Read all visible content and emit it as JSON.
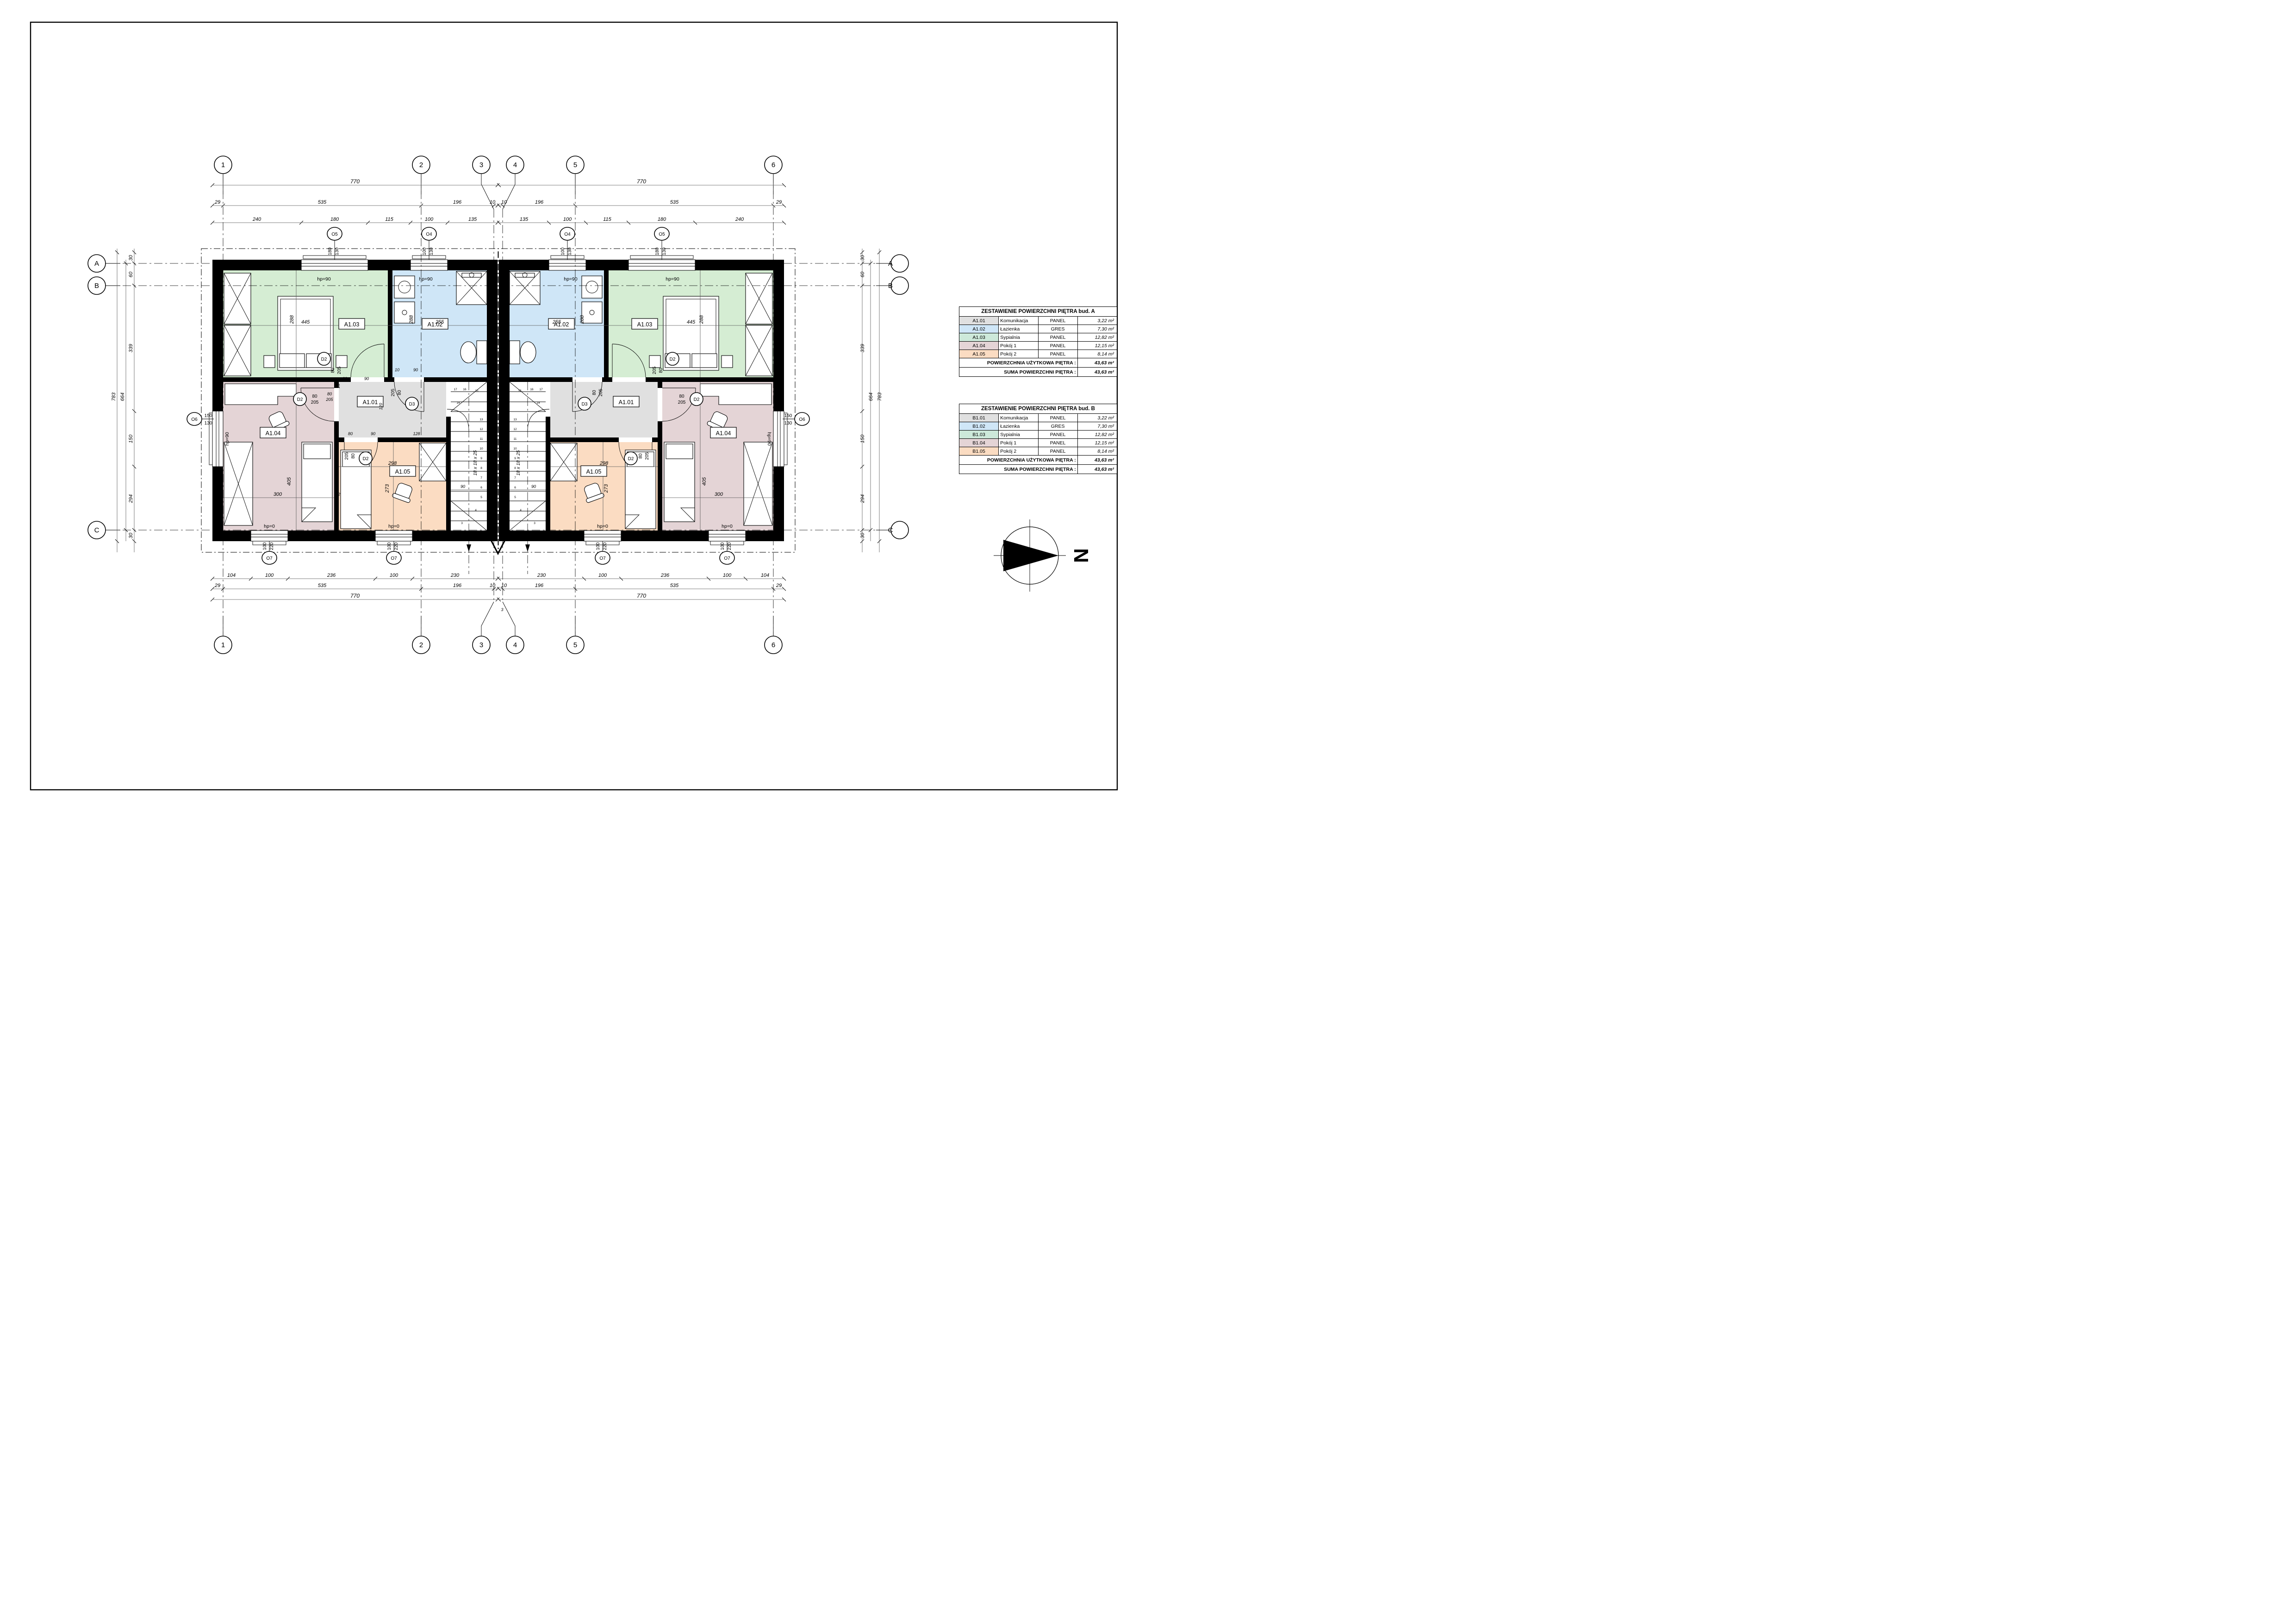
{
  "tables": {
    "a": {
      "title": "ZESTAWIENIE POWIERZCHNI PIĘTRA bud. A",
      "rows": [
        {
          "code": "A1.01",
          "name": "Komunikacja",
          "finish": "PANEL",
          "area": "3,22 m²",
          "color": "#e0e0e0"
        },
        {
          "code": "A1.02",
          "name": "Łazienka",
          "finish": "GRES",
          "area": "7,30 m²",
          "color": "#cfe6f7"
        },
        {
          "code": "A1.03",
          "name": "Sypialnia",
          "finish": "PANEL",
          "area": "12,82 m²",
          "color": "#cde9da"
        },
        {
          "code": "A1.04",
          "name": "Pokój 1",
          "finish": "PANEL",
          "area": "12,15 m²",
          "color": "#e4d4d6"
        },
        {
          "code": "A1.05",
          "name": "Pokój 2",
          "finish": "PANEL",
          "area": "8,14 m²",
          "color": "#fbdcc2"
        }
      ],
      "total_label": "POWIERZCHNIA UŻYTKOWA  PIĘTRA   :",
      "total_value": "43,63 m²",
      "sum_label": "SUMA POWIERZCHNI  PIĘTRA   :",
      "sum_value": "43,63 m²"
    },
    "b": {
      "title": "ZESTAWIENIE POWIERZCHNI PIĘTRA bud. B",
      "rows": [
        {
          "code": "B1.01",
          "name": "Komunikacja",
          "finish": "PANEL",
          "area": "3,22 m²",
          "color": "#e0e0e0"
        },
        {
          "code": "B1.02",
          "name": "Łazienka",
          "finish": "GRES",
          "area": "7,30 m²",
          "color": "#cfe6f7"
        },
        {
          "code": "B1.03",
          "name": "Sypialnia",
          "finish": "PANEL",
          "area": "12,82 m²",
          "color": "#cde9da"
        },
        {
          "code": "B1.04",
          "name": "Pokój 1",
          "finish": "PANEL",
          "area": "12,15 m²",
          "color": "#e4d4d6"
        },
        {
          "code": "B1.05",
          "name": "Pokój 2",
          "finish": "PANEL",
          "area": "8,14 m²",
          "color": "#fbdcc2"
        }
      ],
      "total_label": "POWIERZCHNIA UŻYTKOWA  PIĘTRA   :",
      "total_value": "43,63 m²",
      "sum_label": "SUMA POWIERZCHNI  PIĘTRA   :",
      "sum_value": "43,63 m²"
    }
  },
  "north": {
    "label": "N"
  },
  "colors": {
    "komunikacja": "#e0e0e0",
    "lazienka": "#cfe6f7",
    "sypialnia": "#d5edd3",
    "pokoj1": "#e4d4d6",
    "pokoj2": "#fbdcc2",
    "wall": "#000000"
  },
  "plan": {
    "axes": {
      "cols": [
        "1",
        "2",
        "3",
        "4",
        "5",
        "6"
      ],
      "rows": [
        "A",
        "B",
        "C"
      ]
    },
    "rooms": {
      "a101": "A1.01",
      "a102": "A1.02",
      "a103": "A1.03",
      "a104": "A1.04",
      "a105": "A1.05"
    },
    "hp90": "hp=90",
    "hp0": "hp=0",
    "markers": {
      "o4": {
        "c": "O4",
        "w": "100",
        "h": "130"
      },
      "o5": {
        "c": "O5",
        "w": "180",
        "h": "130"
      },
      "o6": {
        "c": "O6",
        "w": "150",
        "h": "130"
      },
      "o7": {
        "c": "O7",
        "w": "100",
        "h": "220"
      },
      "d2": {
        "c": "D2",
        "w": "80",
        "h": "205"
      },
      "d3": {
        "c": "D3",
        "w": "80",
        "h": "205"
      }
    },
    "stairs": {
      "note": "18 x 18 x 25",
      "width": "90",
      "treads": [
        "3",
        "4",
        "5",
        "6",
        "7",
        "8",
        "9",
        "10",
        "11",
        "12",
        "13",
        "14",
        "15",
        "16",
        "17"
      ]
    },
    "interior": {
      "a103w": "445",
      "a103h": "288",
      "a102w": "255",
      "a102h": "288",
      "a104h": "405",
      "a104w": "300",
      "a105w": "298",
      "a105h": "273",
      "wall12": "12",
      "wall10": "10",
      "c33": "33",
      "c90": "90",
      "c15": "15",
      "c120": "120",
      "c80": "80",
      "c128": "128",
      "c205": "205",
      "gap": "3"
    },
    "dims": {
      "top1": [
        "770",
        "770"
      ],
      "top2": [
        "29",
        "535",
        "196",
        "10",
        "10",
        "196",
        "535",
        "29"
      ],
      "top3": [
        "240",
        "180",
        "115",
        "100",
        "135",
        "135",
        "100",
        "115",
        "180",
        "240"
      ],
      "bot1": [
        "104",
        "100",
        "236",
        "100",
        "230",
        "230",
        "100",
        "236",
        "100",
        "104"
      ],
      "bot2": [
        "29",
        "535",
        "196",
        "10",
        "10",
        "196",
        "535",
        "29"
      ],
      "bot3": [
        "770",
        "770"
      ],
      "side_chain": [
        "30",
        "60",
        "339",
        "150",
        "294",
        "30"
      ],
      "side_mid": "664",
      "side_total": "783"
    }
  }
}
